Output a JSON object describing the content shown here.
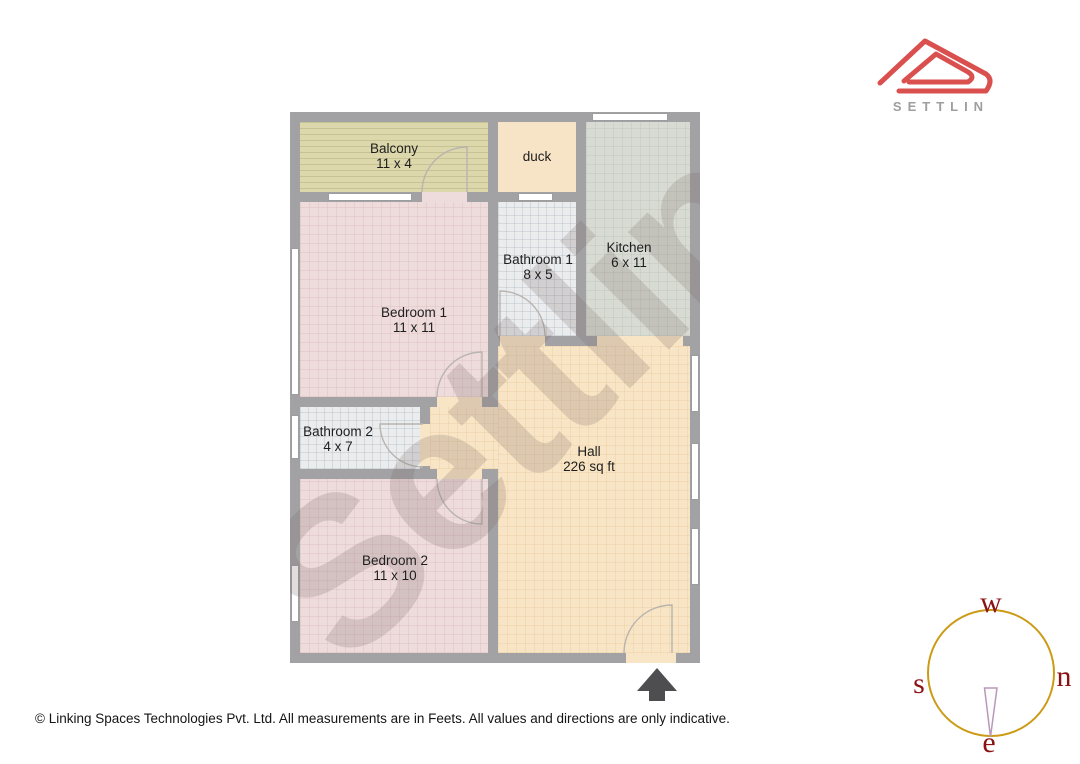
{
  "logo": {
    "brand": "SETTLIN"
  },
  "watermark": "Settlin",
  "rooms": [
    {
      "id": "balcony",
      "name": "Balcony",
      "dims": "11 x 4"
    },
    {
      "id": "duct",
      "name": "duck",
      "dims": ""
    },
    {
      "id": "kitchen",
      "name": "Kitchen",
      "dims": "6 x 11"
    },
    {
      "id": "bathroom1",
      "name": "Bathroom 1",
      "dims": "8 x 5"
    },
    {
      "id": "bedroom1",
      "name": "Bedroom 1",
      "dims": "11 x 11"
    },
    {
      "id": "bathroom2",
      "name": "Bathroom 2",
      "dims": "4 x 7"
    },
    {
      "id": "hall",
      "name": "Hall",
      "dims": "226 sq ft"
    },
    {
      "id": "bedroom2",
      "name": "Bedroom 2",
      "dims": "11 x 10"
    }
  ],
  "compass": {
    "top": "w",
    "right": "n",
    "left": "s",
    "bottom": "e"
  },
  "footer": "© Linking Spaces Technologies Pvt. Ltd. All measurements are in Feets. All values and directions are only indicative.",
  "colors": {
    "wall": "#a2a2a4",
    "balcony_floor": "#dcd8ac",
    "duct_floor": "#f7e4c6",
    "kitchen_floor": "#d8dbd3",
    "bathroom_floor": "#eaecee",
    "bedroom_floor": "#eedcdc",
    "hall_floor": "#f8e5c5",
    "logo_red": "#d9504e",
    "brand_gray": "#9e9e9e",
    "compass_ring": "#cc9b16",
    "compass_text": "#8b1212",
    "entrance_arrow": "#4e4e50"
  }
}
